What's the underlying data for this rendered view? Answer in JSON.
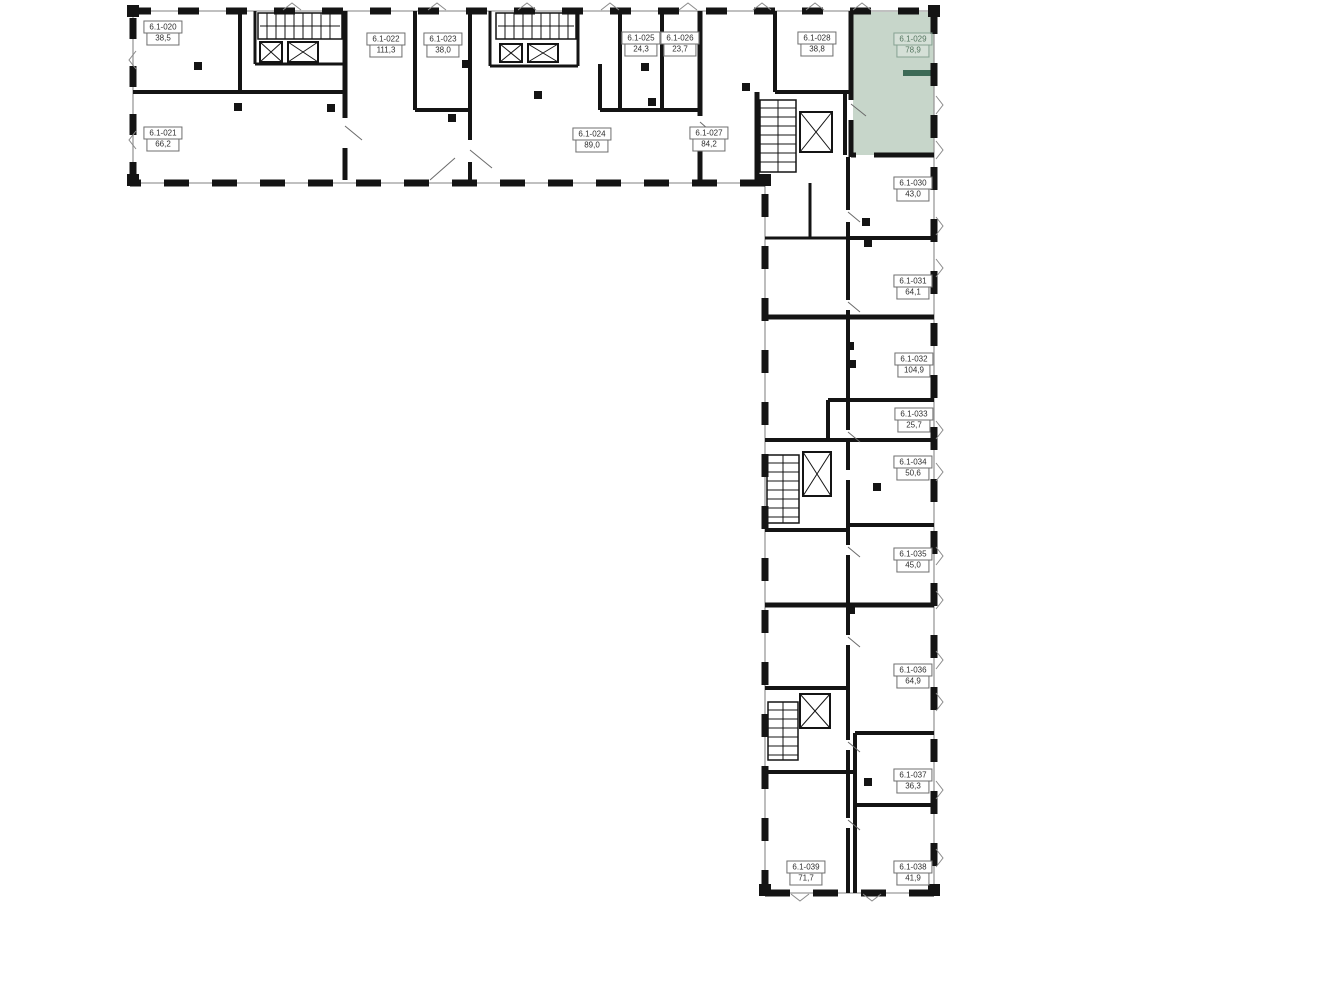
{
  "plan": {
    "wall_color": "#141414",
    "window_line_color": "#9a9a9a",
    "highlight_color": "#c7d6ca",
    "accent_color": "#3d6a56",
    "highlighted_room_id": "6.1-029",
    "rooms": [
      {
        "id": "6.1-020",
        "area": "38,5",
        "x": 163,
        "y": 33,
        "highlighted": false
      },
      {
        "id": "6.1-021",
        "area": "66,2",
        "x": 163,
        "y": 139,
        "highlighted": false
      },
      {
        "id": "6.1-022",
        "area": "111,3",
        "x": 386,
        "y": 45,
        "highlighted": false
      },
      {
        "id": "6.1-023",
        "area": "38,0",
        "x": 443,
        "y": 45,
        "highlighted": false
      },
      {
        "id": "6.1-024",
        "area": "89,0",
        "x": 592,
        "y": 140,
        "highlighted": false
      },
      {
        "id": "6.1-025",
        "area": "24,3",
        "x": 641,
        "y": 44,
        "highlighted": false
      },
      {
        "id": "6.1-026",
        "area": "23,7",
        "x": 680,
        "y": 44,
        "highlighted": false
      },
      {
        "id": "6.1-027",
        "area": "84,2",
        "x": 709,
        "y": 139,
        "highlighted": false
      },
      {
        "id": "6.1-028",
        "area": "38,8",
        "x": 817,
        "y": 44,
        "highlighted": false
      },
      {
        "id": "6.1-029",
        "area": "78,9",
        "x": 913,
        "y": 45,
        "highlighted": true
      },
      {
        "id": "6.1-030",
        "area": "43,0",
        "x": 913,
        "y": 189,
        "highlighted": false
      },
      {
        "id": "6.1-031",
        "area": "64,1",
        "x": 913,
        "y": 287,
        "highlighted": false
      },
      {
        "id": "6.1-032",
        "area": "104,9",
        "x": 914,
        "y": 365,
        "highlighted": false
      },
      {
        "id": "6.1-033",
        "area": "25,7",
        "x": 914,
        "y": 420,
        "highlighted": false
      },
      {
        "id": "6.1-034",
        "area": "50,6",
        "x": 913,
        "y": 468,
        "highlighted": false
      },
      {
        "id": "6.1-035",
        "area": "45,0",
        "x": 913,
        "y": 560,
        "highlighted": false
      },
      {
        "id": "6.1-036",
        "area": "64,9",
        "x": 913,
        "y": 676,
        "highlighted": false
      },
      {
        "id": "6.1-037",
        "area": "36,3",
        "x": 913,
        "y": 781,
        "highlighted": false
      },
      {
        "id": "6.1-038",
        "area": "41,9",
        "x": 913,
        "y": 873,
        "highlighted": false
      },
      {
        "id": "6.1-039",
        "area": "71,7",
        "x": 806,
        "y": 873,
        "highlighted": false
      }
    ]
  }
}
